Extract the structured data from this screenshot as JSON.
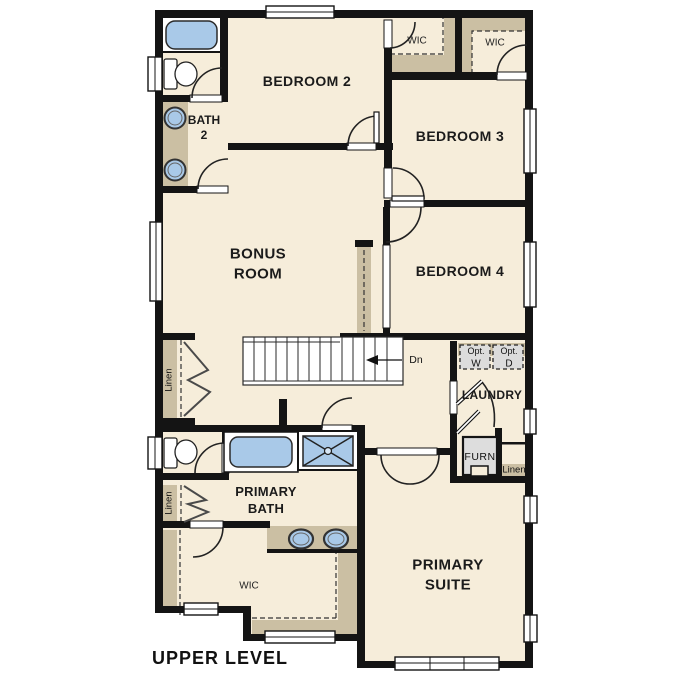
{
  "plan_title": "UPPER LEVEL",
  "colors": {
    "floor": "#f6edda",
    "wall": "#141414",
    "cabinet_tan": "#cbbfa3",
    "fixture_blue": "#a9c9e8",
    "appliance_gray": "#dcdcdc"
  },
  "rooms": {
    "bedroom_2": {
      "label": "BEDROOM 2"
    },
    "bedroom_3": {
      "label": "BEDROOM 3"
    },
    "bedroom_4": {
      "label": "BEDROOM 4"
    },
    "bonus_room": {
      "line1": "BONUS",
      "line2": "ROOM"
    },
    "primary_suite": {
      "line1": "PRIMARY",
      "line2": "SUITE"
    },
    "primary_bath": {
      "line1": "PRIMARY",
      "line2": "BATH"
    },
    "bath_2": {
      "line1": "BATH",
      "line2": "2"
    },
    "laundry": {
      "label": "LAUNDRY"
    }
  },
  "closets": {
    "wic_bedroom_2": {
      "label": "WIC"
    },
    "wic_bedroom_3": {
      "label": "WIC"
    },
    "wic_primary": {
      "label": "WIC"
    },
    "linen_hall_upper": {
      "label": "Linen"
    },
    "linen_hall_lower": {
      "label": "Linen"
    },
    "linen_laundry": {
      "label": "Linen"
    }
  },
  "equipment": {
    "furnace": {
      "label": "FURN"
    },
    "washer": {
      "option_label": "Opt.",
      "label": "W"
    },
    "dryer": {
      "option_label": "Opt.",
      "label": "D"
    }
  },
  "stairs": {
    "down_label": "Dn"
  }
}
